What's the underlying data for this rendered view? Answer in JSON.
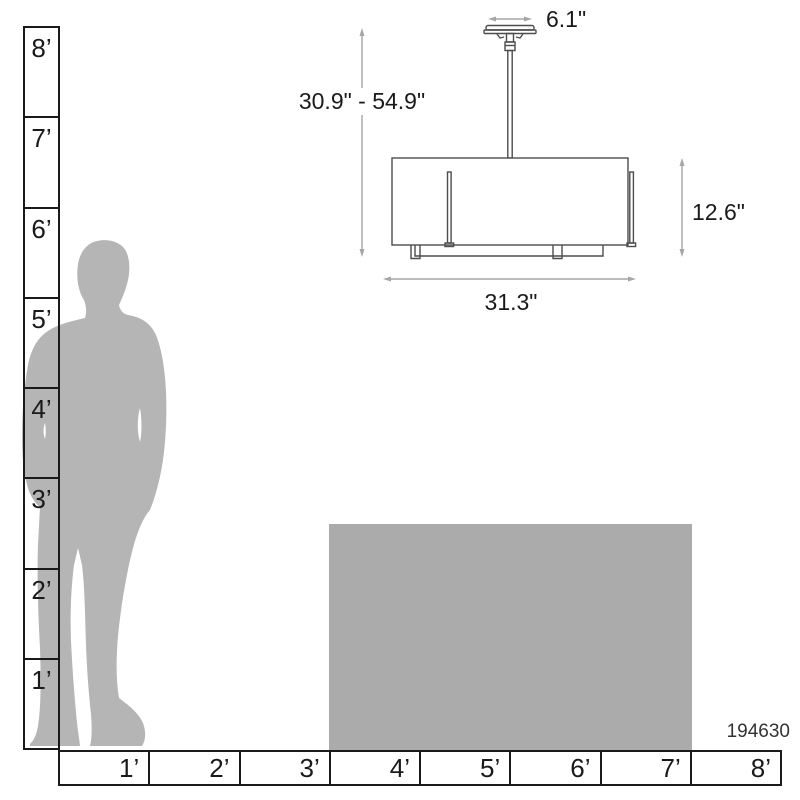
{
  "product_code": "194630",
  "diagram": {
    "type": "pendant-light-dimension-diagram",
    "canopy_width": "6.1\"",
    "height_range": "30.9\" - 54.9\"",
    "shade_height": "12.6\"",
    "shade_width": "31.3\""
  },
  "rulers": {
    "vertical_feet": [
      "8’",
      "7’",
      "6’",
      "5’",
      "4’",
      "3’",
      "2’",
      "1’"
    ],
    "horizontal_feet": [
      "1’",
      "2’",
      "3’",
      "4’",
      "5’",
      "6’",
      "7’",
      "8’"
    ]
  },
  "colors": {
    "silhouette_gray": "#b5b5b5",
    "reference_block_gray": "#ababab",
    "dimension_line_gray": "#a6a6a6",
    "drawing_stroke": "#4d4d4d",
    "ruler_stroke": "#1a1a1a",
    "text": "#1a1a1a"
  }
}
